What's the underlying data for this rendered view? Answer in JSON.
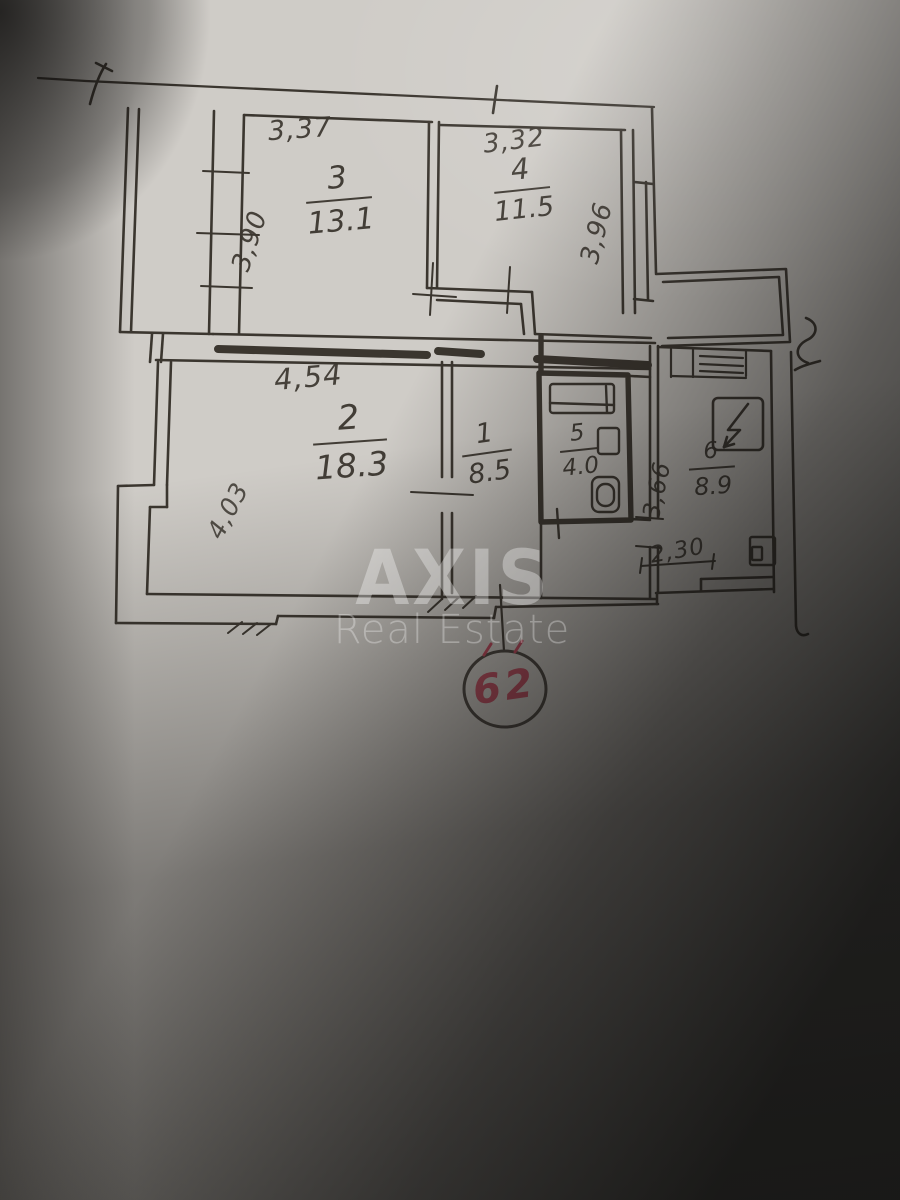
{
  "watermark": {
    "brand": "AXIS",
    "subtitle": "Real Estate"
  },
  "unit": {
    "number": "62"
  },
  "rooms": [
    {
      "key": "room1",
      "number": "1",
      "area": "8.5"
    },
    {
      "key": "room2",
      "number": "2",
      "area": "18.3"
    },
    {
      "key": "room3",
      "number": "3",
      "area": "13.1"
    },
    {
      "key": "room4",
      "number": "4",
      "area": "11.5"
    },
    {
      "key": "room5",
      "number": "5",
      "area": "4.0"
    },
    {
      "key": "room6",
      "number": "6",
      "area": "8.9"
    }
  ],
  "dimensions": {
    "room3_top": "3,37",
    "room3_left": "3,90",
    "room4_top": "3,32",
    "room4_right": "3,96",
    "room2_top": "4,54",
    "room2_left": "4,03",
    "room6_left": "3,66",
    "room6_bottom": "2,30"
  },
  "colors": {
    "paper": "#cfccc7",
    "ink": "#3b362f",
    "red_pen": "#c2445a",
    "watermark": "#ffffff"
  }
}
